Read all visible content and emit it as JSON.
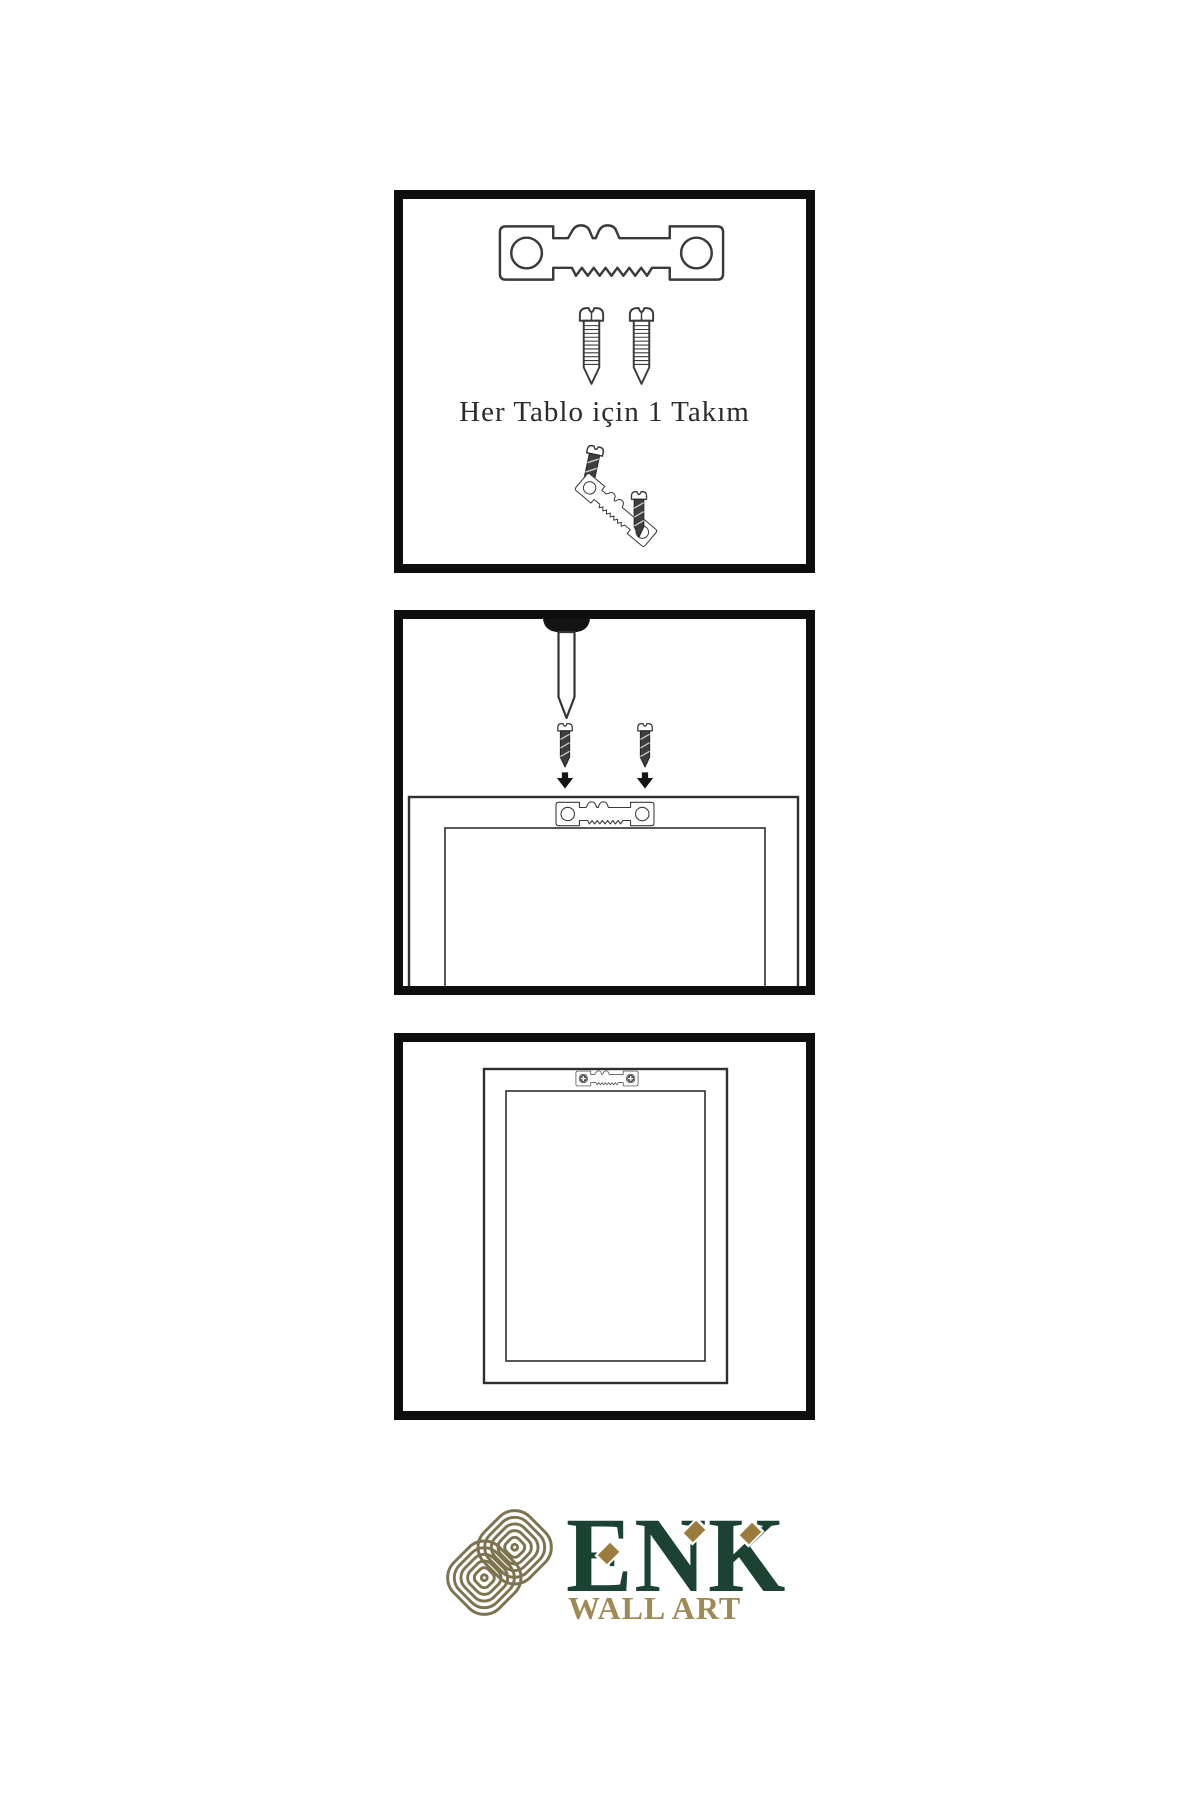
{
  "panel1": {
    "caption": "Her Tablo için 1 Takım"
  },
  "logo": {
    "brand": "ENK",
    "tagline": "WALL ART"
  },
  "colors": {
    "background": "#ffffff",
    "panel_border": "#0e0e0e",
    "line": "#3a3a3a",
    "dark_screw_fill": "#3f3f3f",
    "brand_green": "#1c4233",
    "knot_gold": "#7d744f",
    "ornament_gold": "#9c7c3c",
    "tagline_gold": "#9f8a55"
  },
  "icons": [
    "sawtooth-hanger-icon",
    "screw-icon",
    "dark-screw-icon",
    "down-arrow-icon",
    "nail-icon",
    "frame-back-icon",
    "phillips-screw-icon",
    "knot-logo-icon",
    "diamond-ornament-icon"
  ]
}
